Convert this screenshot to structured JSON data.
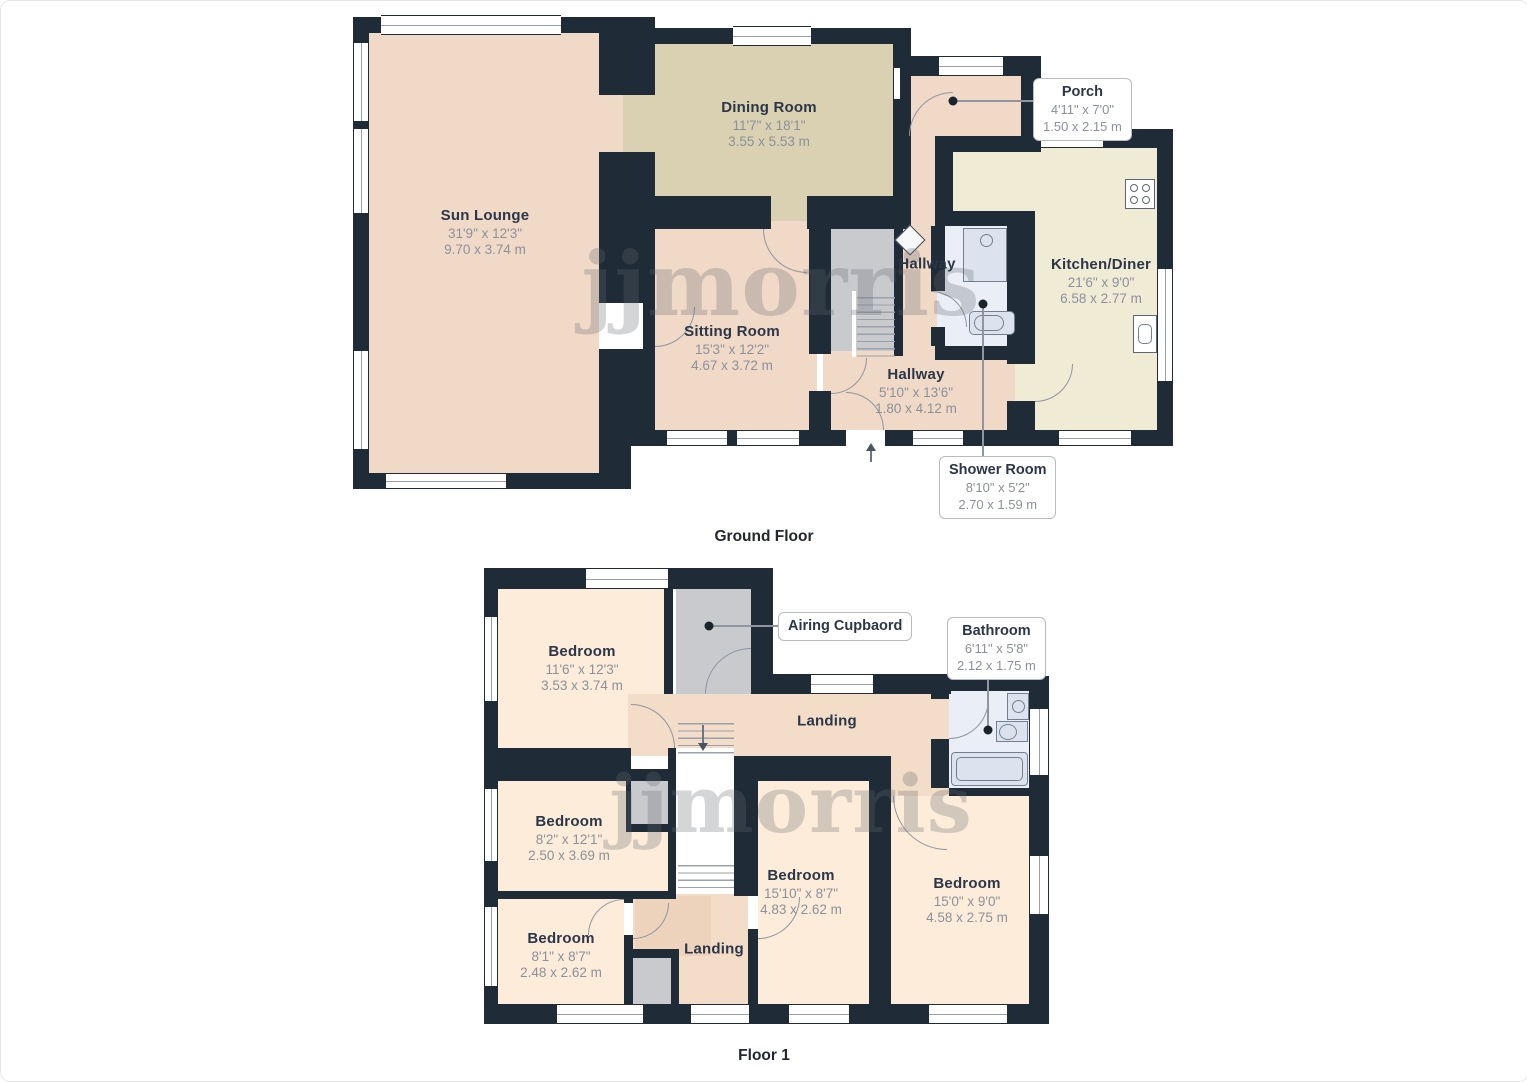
{
  "watermark": "jjmorris",
  "colors": {
    "wall": "#202b38",
    "pink": "#f1d9c8",
    "tan": "#dad1b2",
    "cream": "#f0ebd5",
    "cream2": "#fdecd9",
    "pink2": "#f3dcc8",
    "pink2d": "#eed3bc",
    "gray": "#c9cacd",
    "bath": "#eaeef6",
    "white": "#ffffff",
    "fixture": "#dce3ef",
    "fixtureBorder": "#74808f",
    "arc": "#8f959e",
    "leader": "#9096a0",
    "dot": "#1a222c",
    "labelDark": "#2b3748",
    "labelGray": "#8b919b",
    "wm": "rgba(98,104,112,0.28)",
    "calloutBorder": "#b7bbc2"
  },
  "ground_floor": {
    "caption": "Ground Floor",
    "rooms": [
      {
        "name": "Sun Lounge",
        "dim_ft": "31'9\" x 12'3\"",
        "dim_m": "9.70 x 3.74 m"
      },
      {
        "name": "Dining Room",
        "dim_ft": "11'7\" x 18'1\"",
        "dim_m": "3.55 x 5.53 m"
      },
      {
        "name": "Sitting Room",
        "dim_ft": "15'3\" x 12'2\"",
        "dim_m": "4.67 x 3.72 m"
      },
      {
        "name": "Kitchen/Diner",
        "dim_ft": "21'6\" x 9'0\"",
        "dim_m": "6.58 x 2.77 m"
      },
      {
        "name": "Hallway",
        "dim_ft": "5'10\" x 13'6\"",
        "dim_m": "1.80 x 4.12 m"
      },
      {
        "name": "Hallway"
      }
    ],
    "callouts": [
      {
        "name": "Porch",
        "dim_ft": "4'11\" x 7'0\"",
        "dim_m": "1.50 x 2.15 m"
      },
      {
        "name": "Shower Room",
        "dim_ft": "8'10\" x 5'2\"",
        "dim_m": "2.70 x 1.59 m"
      }
    ]
  },
  "floor_1": {
    "caption": "Floor 1",
    "rooms": [
      {
        "name": "Bedroom",
        "dim_ft": "11'6\" x 12'3\"",
        "dim_m": "3.53 x 3.74 m"
      },
      {
        "name": "Bedroom",
        "dim_ft": "8'2\" x 12'1\"",
        "dim_m": "2.50 x 3.69 m"
      },
      {
        "name": "Bedroom",
        "dim_ft": "8'1\" x 8'7\"",
        "dim_m": "2.48 x 2.62 m"
      },
      {
        "name": "Bedroom",
        "dim_ft": "15'10\" x 8'7\"",
        "dim_m": "4.83 x 2.62 m"
      },
      {
        "name": "Bedroom",
        "dim_ft": "15'0\" x 9'0\"",
        "dim_m": "4.58 x 2.75 m"
      },
      {
        "name": "Landing"
      },
      {
        "name": "Landing"
      }
    ],
    "callouts": [
      {
        "name": "Airing Cupbaord"
      },
      {
        "name": "Bathroom",
        "dim_ft": "6'11\" x 5'8\"",
        "dim_m": "2.12 x 1.75 m"
      }
    ]
  }
}
